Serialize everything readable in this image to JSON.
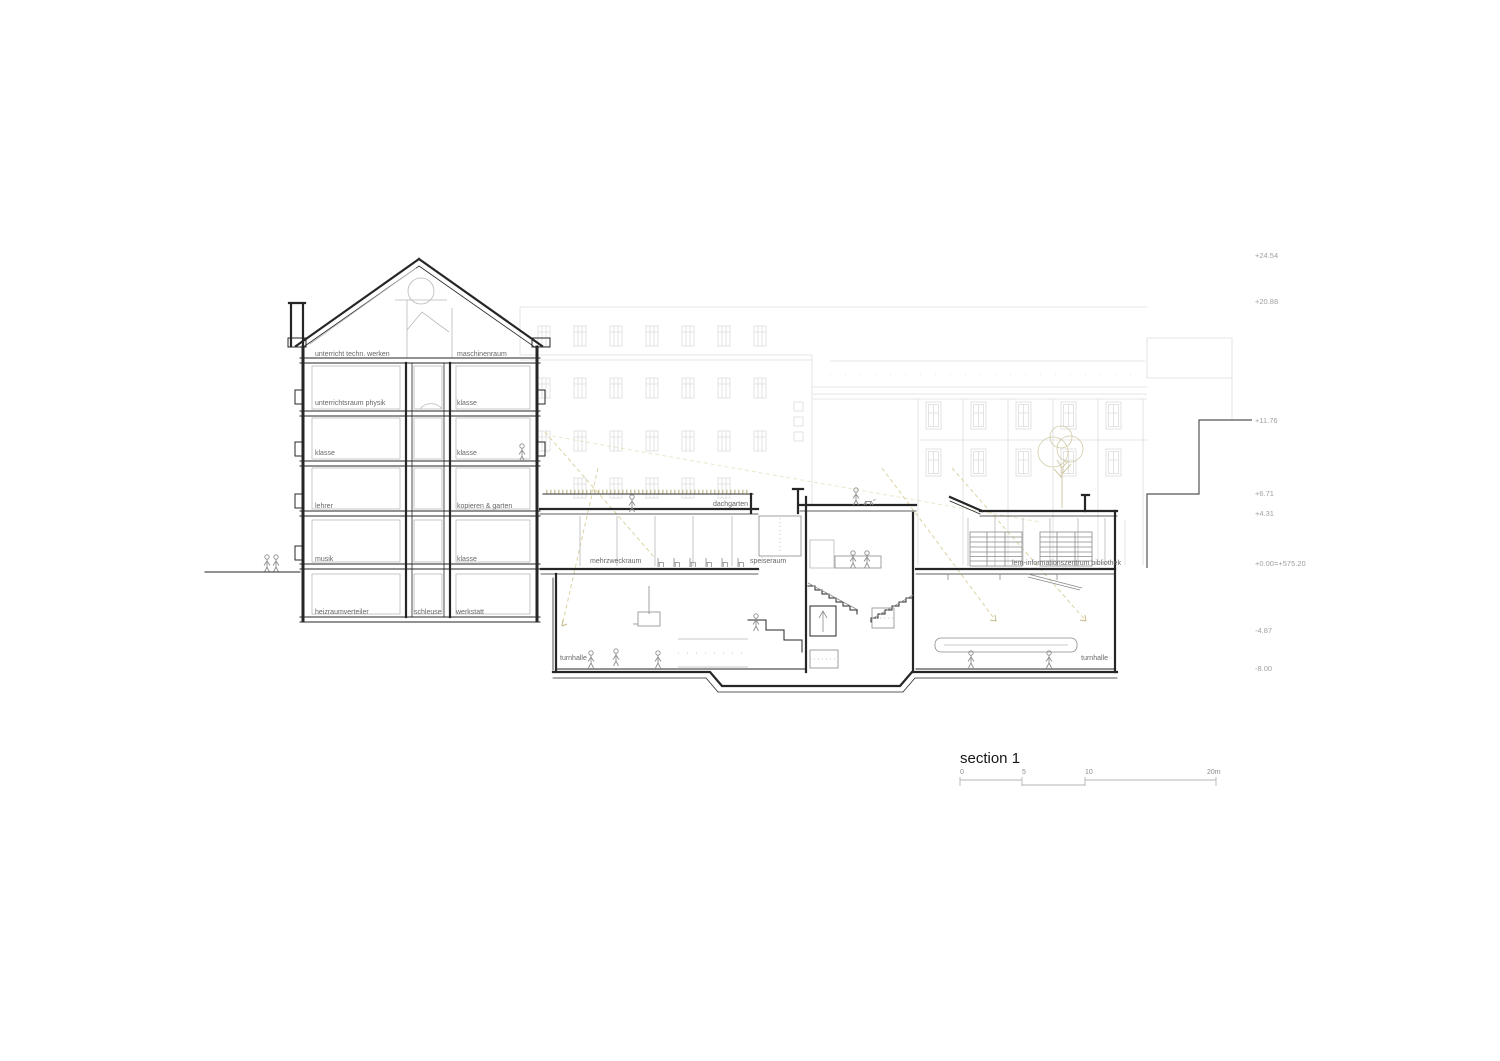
{
  "title": {
    "text": "section 1"
  },
  "scale_bar": {
    "ticks": [
      "0",
      "5",
      "10",
      "20m"
    ]
  },
  "elevations": [
    "+24.54",
    "+20.88",
    "+11.76",
    "+6.71",
    "+4.31",
    "+0.00=+575.20",
    "-4.87",
    "-8.00"
  ],
  "rooms": {
    "attic_left": "unterricht techn. werken",
    "attic_right": "maschinenraum",
    "f3_left": "unterrichtsraum physik",
    "f3_right": "klasse",
    "f2_left": "klasse",
    "f2_right": "klasse",
    "f1_left": "lehrer",
    "f1_right": "kopieren & garten",
    "f0_left": "musik",
    "f0_right": "klasse",
    "b_left": "heizraumverteiler",
    "b_mid": "schleuse",
    "b_right": "werkstatt",
    "dachgarten": "dachgarten",
    "mehrzweckraum": "mehrzweckraum",
    "speiseraum": "speiseraum",
    "bibliothek": "lern-informationszentrum bibliothek",
    "turnhalle_left": "turnhalle",
    "turnhalle_right": "turnhalle"
  },
  "colors": {
    "ink": "#262626",
    "background_lines": "#dcdcdc",
    "vegetation": "#c3ba8a",
    "daylight_dash": "#dbd3a2",
    "label_text": "#676767",
    "elevation_text": "#a0a0a0"
  }
}
